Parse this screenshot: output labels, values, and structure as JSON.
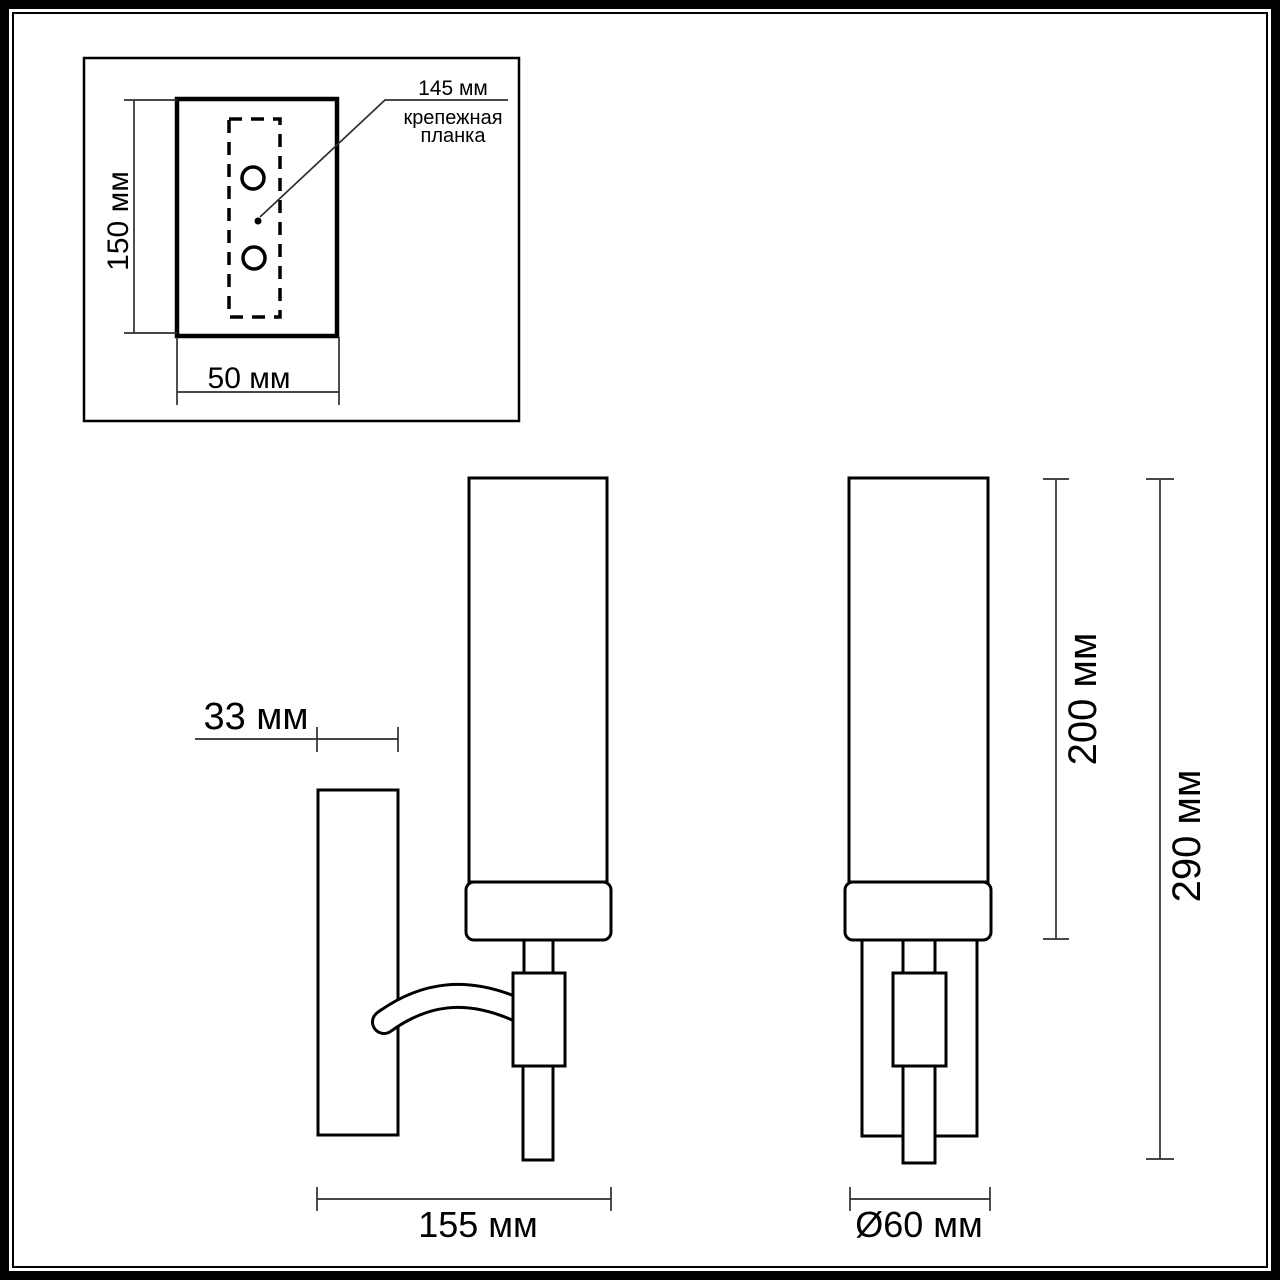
{
  "colors": {
    "ink": "#000000",
    "line": "#2e2e2e",
    "background": "#ffffff"
  },
  "inset": {
    "height_label": "150 мм",
    "width_label": "50 мм",
    "leader_value_label": "145 мм",
    "leader_caption_lines": [
      "крепежная",
      "планка"
    ]
  },
  "side_view": {
    "depth_label": "33 мм",
    "width_label": "155 мм"
  },
  "front_view": {
    "shade_height_label": "200 мм",
    "overall_height_label": "290 мм",
    "diameter_label": "Ø60 мм"
  }
}
